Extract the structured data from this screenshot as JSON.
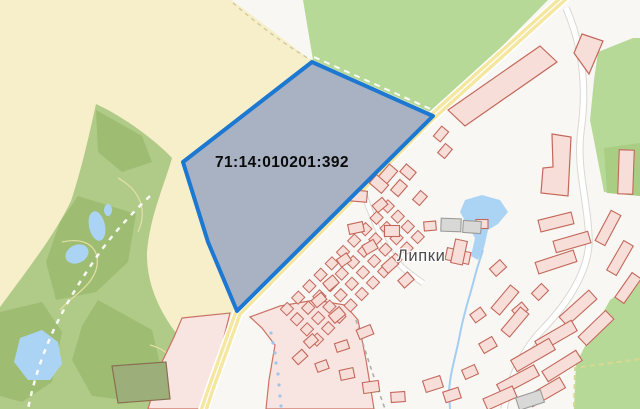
{
  "map": {
    "width": 640,
    "height": 409,
    "parcel": {
      "label": "71:14:010201:392",
      "points": "312,62 433,116 237,311 208,242 183,162",
      "fill": "#a9b2c3",
      "stroke": "#1d78d1",
      "stroke_width": 4
    },
    "village_label": {
      "text": "Липки",
      "color": "#424242"
    },
    "palette": {
      "background": "#f8f7f3",
      "field_yellow": "#f6efc9",
      "meadow_green": "#b7d998",
      "forest_olive": "#b0ca88",
      "forest_dark": "#9ebc72",
      "water": "#abd4f4",
      "road_yellow": "#f6e7a0",
      "road_casing": "#ffffff",
      "building_fill": "#f8ded8",
      "building_stroke": "#c4675b",
      "building_gray": "#d8d8d6",
      "building_gray_stroke": "#9b9b99",
      "zone_pink": "#f8e5e2",
      "zone_stroke": "#cb7263",
      "parcel_fill": "#a9b2c3",
      "parcel_stroke": "#1d78d1"
    },
    "shapes": [
      {
        "name": "field-yellow",
        "tag": "polygon",
        "attrs": {
          "points": "0,0 232,0 313,60 435,114 237,311 203,409 0,409",
          "fill": "#f6efc9"
        }
      },
      {
        "name": "white-wedge",
        "tag": "polygon",
        "attrs": {
          "points": "232,0 304,0 312,61",
          "fill": "#f8f7f3"
        }
      },
      {
        "name": "meadow-green",
        "tag": "polygon",
        "attrs": {
          "points": "303,0 548,0 435,114 313,60",
          "fill": "#b7d998"
        }
      },
      {
        "name": "path-tan-dashed",
        "tag": "path",
        "attrs": {
          "d": "M 233,3 C 255,22 282,43 311,60",
          "fill": "none",
          "stroke": "#d5caa0",
          "stroke-width": 1.5,
          "stroke-dasharray": "4 4"
        }
      },
      {
        "name": "forest-olive",
        "tag": "path",
        "attrs": {
          "d": "M 96,104 C 126,118 156,141 172,158 C 164,186 150,216 147,252 C 146,286 162,316 180,338 L 172,372 L 166,409 L 0,409 L 0,307 C 28,269 56,233 71,201 C 81,171 89,136 96,104 Z",
          "fill": "#b0ca88"
        }
      },
      {
        "name": "forest-dark-patch",
        "tag": "polygon",
        "attrs": {
          "points": "78,196 136,214 128,262 96,292 56,300 46,262 60,222",
          "fill": "#9ebc72"
        }
      },
      {
        "name": "forest-dark-patch",
        "tag": "polygon",
        "attrs": {
          "points": "98,300 152,330 162,372 142,402 92,396 72,360 82,326",
          "fill": "#9ebc72"
        }
      },
      {
        "name": "forest-dark-patch",
        "tag": "polygon",
        "attrs": {
          "points": "96,110 142,136 152,162 122,172 98,152",
          "fill": "#9ebc72"
        }
      },
      {
        "name": "forest-dark-patch",
        "tag": "polygon",
        "attrs": {
          "points": "0,312 42,302 62,332 52,382 22,402 0,396",
          "fill": "#9ebc72"
        }
      },
      {
        "name": "contour-line",
        "tag": "path",
        "attrs": {
          "d": "M 62,242 C 88,236 102,250 96,270 C 90,288 72,296 60,310",
          "fill": "none",
          "stroke": "#e0dfa2",
          "stroke-width": 1.3
        }
      },
      {
        "name": "contour-line",
        "tag": "path",
        "attrs": {
          "d": "M 118,178 C 140,190 148,210 138,232",
          "fill": "none",
          "stroke": "#e0dfa2",
          "stroke-width": 1.3
        }
      },
      {
        "name": "contour-line",
        "tag": "path",
        "attrs": {
          "d": "M 150,345 C 170,350 180,365 172,382",
          "fill": "none",
          "stroke": "#e0dfa2",
          "stroke-width": 1.3
        }
      },
      {
        "name": "green-top-right",
        "tag": "polygon",
        "attrs": {
          "points": "598,52 633,38 640,38 640,196 604,192 590,120 594,80",
          "fill": "#b7d998"
        }
      },
      {
        "name": "green-top-right-dark",
        "tag": "polygon",
        "attrs": {
          "points": "604,148 640,143 640,196 607,193",
          "fill": "#a8cd83"
        }
      },
      {
        "name": "green-bottom-right",
        "tag": "polygon",
        "attrs": {
          "points": "640,278 610,300 590,336 576,364 574,409 640,409",
          "fill": "#b7d998"
        }
      },
      {
        "name": "green-boundary-dashed",
        "tag": "path",
        "attrs": {
          "d": "M 574,407 L 575,368 L 640,359",
          "fill": "none",
          "stroke": "#d8d98f",
          "stroke-width": 2,
          "stroke-dasharray": "5 4"
        }
      },
      {
        "name": "pink-strip-left",
        "tag": "polygon",
        "attrs": {
          "points": "182,318 230,313 206,409 148,409 162,362 174,337",
          "fill": "#f8e5e2",
          "stroke": "#cb7263",
          "stroke-width": 1.2
        }
      },
      {
        "name": "farm-compound",
        "tag": "polygon",
        "attrs": {
          "points": "112,366 166,362 170,399 118,403",
          "fill": "#9cae7a",
          "stroke": "#897050",
          "stroke-width": 1.2
        }
      },
      {
        "name": "pink-zone-center",
        "tag": "polygon",
        "attrs": {
          "points": "250,317 280,306 315,300 345,305 358,320 366,360 374,409 266,409 269,380 275,345 262,328",
          "fill": "#f8e5e2",
          "stroke": "#cb7263",
          "stroke-width": 1.2
        }
      },
      {
        "name": "pond",
        "tag": "ellipse",
        "attrs": {
          "cx": 97,
          "cy": 226,
          "rx": 8,
          "ry": 15,
          "transform": "rotate(-12 97 226)",
          "fill": "#abd4f4"
        }
      },
      {
        "name": "pond",
        "tag": "ellipse",
        "attrs": {
          "cx": 77,
          "cy": 254,
          "rx": 12,
          "ry": 9,
          "transform": "rotate(-25 77 254)",
          "fill": "#abd4f4"
        }
      },
      {
        "name": "pond",
        "tag": "ellipse",
        "attrs": {
          "cx": 108,
          "cy": 210,
          "rx": 4,
          "ry": 6,
          "fill": "#abd4f4"
        }
      },
      {
        "name": "pond-large",
        "tag": "polygon",
        "attrs": {
          "points": "20,338 42,330 58,342 62,364 50,380 28,380 14,362",
          "fill": "#abd4f4"
        }
      },
      {
        "name": "village-pond",
        "tag": "polygon",
        "attrs": {
          "points": "465,200 482,195 500,200 508,212 498,224 488,230 484,248 478,260 471,256 475,238 468,226 460,212",
          "fill": "#abd4f4"
        }
      },
      {
        "name": "forest-path-dashed",
        "tag": "path",
        "attrs": {
          "d": "M 150,196 C 130,215 112,235 98,255 C 84,275 68,300 56,325 C 44,350 34,378 28,409",
          "fill": "none",
          "stroke": "#ffffff",
          "stroke-width": 2.5,
          "stroke-dasharray": "5 6",
          "opacity": 0.9
        }
      },
      {
        "name": "street-casing",
        "tag": "path",
        "attrs": {
          "d": "M 566,8 C 580,40 588,80 581,130 C 576,170 588,200 589,240 C 589,272 566,305 544,328 C 522,350 510,378 504,409",
          "fill": "none",
          "stroke": "#dad8d0",
          "stroke-width": 7.5
        }
      },
      {
        "name": "street-fill",
        "tag": "path",
        "attrs": {
          "d": "M 566,8 C 580,40 588,80 581,130 C 576,170 588,200 589,240 C 589,272 566,305 544,328 C 522,350 510,378 504,409",
          "fill": "none",
          "stroke": "#ffffff",
          "stroke-width": 5.5
        }
      },
      {
        "name": "street-casing",
        "tag": "path",
        "attrs": {
          "d": "M 357,172 C 366,202 377,230 388,250 C 397,265 410,274 423,283",
          "fill": "none",
          "stroke": "#dad8d0",
          "stroke-width": 6.5
        }
      },
      {
        "name": "street-fill",
        "tag": "path",
        "attrs": {
          "d": "M 357,172 C 366,202 377,230 388,250 C 397,265 410,274 423,283",
          "fill": "none",
          "stroke": "#ffffff",
          "stroke-width": 4.5
        }
      },
      {
        "name": "main-road-casing",
        "tag": "path",
        "attrs": {
          "d": "M 566,-4 L 433,116 L 238,313 L 210,391 L 203,412",
          "fill": "none",
          "stroke": "#ffffff",
          "stroke-width": 11,
          "stroke-linejoin": "round"
        }
      },
      {
        "name": "main-road-fill",
        "tag": "path",
        "attrs": {
          "d": "M 566,-4 L 433,116 L 238,313 L 210,391 L 203,412",
          "fill": "none",
          "stroke": "#f6e7a0",
          "stroke-width": 8,
          "stroke-linejoin": "round"
        }
      },
      {
        "name": "main-road-centerline",
        "tag": "path",
        "attrs": {
          "d": "M 566,-4 L 433,116 L 238,313 L 210,391 L 203,412",
          "fill": "none",
          "stroke": "#ffffff",
          "stroke-width": 1.2,
          "stroke-linejoin": "round"
        }
      },
      {
        "name": "trail-gray-dashed",
        "tag": "path",
        "attrs": {
          "d": "M 356,320 C 364,348 374,378 385,409",
          "fill": "none",
          "stroke": "#b0aea6",
          "stroke-width": 1.6,
          "stroke-dasharray": "4 4"
        }
      },
      {
        "name": "stream-dotted",
        "tag": "dots",
        "r": 1.6,
        "fill": "#9cc6ec",
        "points": [
          [
            271,
            333
          ],
          [
            273,
            343
          ],
          [
            275,
            353
          ],
          [
            276,
            363
          ],
          [
            278,
            374
          ],
          [
            279,
            385
          ],
          [
            280,
            396
          ],
          [
            281,
            406
          ]
        ]
      },
      {
        "name": "stream",
        "tag": "path",
        "attrs": {
          "d": "M 483,250 C 479,262 477,268 475,276 C 470,296 464,312 460,334 C 456,356 450,372 449,392 L 450,409",
          "fill": "none",
          "stroke": "#a3cdf2",
          "stroke-width": 2
        }
      },
      {
        "name": "parcel-grid",
        "tag": "grid",
        "spec": {
          "origin": [
            287,
            309
          ],
          "u": [
            11.2,
            -11.4
          ],
          "v": [
            10.0,
            10.2
          ],
          "cols": 10,
          "rows": 4,
          "cell": [
            9.6,
            9.0
          ],
          "rot": -45.5,
          "fill": "#f8ded8",
          "stroke": "#c4675b"
        }
      },
      {
        "name": "building-parallelogram",
        "tag": "polygon",
        "attrs": {
          "points": "448,110 540,46 557,62 465,126",
          "fill": "#f8ded8",
          "stroke": "#c4675b",
          "stroke-width": 1.2
        }
      },
      {
        "name": "building-flag",
        "tag": "polygon",
        "attrs": {
          "points": "582,34 603,41 589,74 574,53",
          "fill": "#f8ded8",
          "stroke": "#c4675b",
          "stroke-width": 1.2
        }
      },
      {
        "name": "building-L",
        "tag": "polygon",
        "attrs": {
          "points": "552,134 571,137 568,196 541,193 543,168 553,167",
          "fill": "#f8ded8",
          "stroke": "#c4675b",
          "stroke-width": 1.2
        }
      },
      {
        "tag": "b",
        "r": [
          374,
          163,
          15,
          11,
          -49
        ]
      },
      {
        "tag": "b",
        "r": [
          388,
          174,
          17,
          11,
          -49
        ]
      },
      {
        "tag": "b",
        "r": [
          379,
          184,
          11,
          16,
          -49
        ]
      },
      {
        "tag": "b",
        "r": [
          399,
          188,
          14,
          10,
          -49
        ]
      },
      {
        "tag": "b",
        "r": [
          408,
          172,
          10,
          13,
          -49
        ]
      },
      {
        "tag": "b",
        "r": [
          420,
          198,
          12,
          9,
          -49
        ]
      },
      {
        "tag": "b",
        "r": [
          441,
          134,
          13,
          9,
          -50
        ]
      },
      {
        "tag": "b",
        "r": [
          445,
          151,
          12,
          9,
          -50
        ]
      },
      {
        "tag": "b",
        "r": [
          358,
          196,
          18,
          11,
          5
        ]
      },
      {
        "tag": "b",
        "r": [
          380,
          205,
          13,
          9,
          -40
        ]
      },
      {
        "tag": "b",
        "r": [
          356,
          228,
          15,
          10,
          -12
        ]
      },
      {
        "tag": "b",
        "r": [
          370,
          247,
          13,
          10,
          -30
        ]
      },
      {
        "tag": "b",
        "r": [
          390,
          265,
          14,
          10,
          -42
        ]
      },
      {
        "tag": "b",
        "r": [
          406,
          280,
          13,
          10,
          -42
        ]
      },
      {
        "tag": "b",
        "r": [
          344,
          260,
          12,
          9,
          -35
        ]
      },
      {
        "tag": "b",
        "r": [
          331,
          283,
          13,
          10,
          -40
        ]
      },
      {
        "tag": "b",
        "r": [
          319,
          300,
          13,
          9,
          -40
        ]
      },
      {
        "tag": "b",
        "r": [
          337,
          315,
          14,
          10,
          -40
        ]
      },
      {
        "tag": "b",
        "r": [
          365,
          332,
          15,
          10,
          -22
        ]
      },
      {
        "tag": "b",
        "r": [
          342,
          346,
          13,
          9,
          -18
        ]
      },
      {
        "tag": "b",
        "r": [
          311,
          341,
          12,
          9,
          -42
        ]
      },
      {
        "tag": "b",
        "r": [
          300,
          357,
          13,
          9,
          -42
        ]
      },
      {
        "tag": "b",
        "r": [
          322,
          366,
          12,
          9,
          -20
        ]
      },
      {
        "tag": "b",
        "r": [
          347,
          374,
          14,
          10,
          -12
        ]
      },
      {
        "tag": "b",
        "r": [
          371,
          387,
          16,
          11,
          -8
        ]
      },
      {
        "tag": "b",
        "r": [
          398,
          397,
          14,
          10,
          -4
        ]
      },
      {
        "tag": "b",
        "r": [
          392,
          231,
          15,
          11,
          0
        ]
      },
      {
        "tag": "b",
        "r": [
          458,
          256,
          24,
          12,
          12
        ]
      },
      {
        "tag": "b",
        "r": [
          459,
          252,
          12,
          24,
          12
        ]
      },
      {
        "tag": "b",
        "r": [
          482,
          224,
          12,
          9,
          0
        ]
      },
      {
        "tag": "b",
        "r": [
          430,
          226,
          12,
          9,
          -5
        ]
      },
      {
        "tag": "b",
        "r": [
          556,
          222,
          34,
          12,
          -14
        ]
      },
      {
        "tag": "b",
        "r": [
          572,
          242,
          36,
          12,
          -16
        ]
      },
      {
        "tag": "b",
        "r": [
          556,
          262,
          40,
          12,
          -18
        ]
      },
      {
        "tag": "b",
        "r": [
          608,
          228,
          34,
          11,
          -62
        ]
      },
      {
        "tag": "b",
        "r": [
          620,
          258,
          34,
          11,
          -60
        ]
      },
      {
        "tag": "b",
        "r": [
          628,
          288,
          30,
          11,
          -55
        ]
      },
      {
        "tag": "b",
        "r": [
          578,
          308,
          40,
          12,
          -42
        ]
      },
      {
        "tag": "b",
        "r": [
          596,
          328,
          38,
          12,
          -44
        ]
      },
      {
        "tag": "b",
        "r": [
          556,
          336,
          42,
          12,
          -30
        ]
      },
      {
        "tag": "b",
        "r": [
          533,
          355,
          44,
          13,
          -30
        ]
      },
      {
        "tag": "b",
        "r": [
          562,
          366,
          40,
          12,
          -32
        ]
      },
      {
        "tag": "b",
        "r": [
          518,
          380,
          42,
          12,
          -28
        ]
      },
      {
        "tag": "b",
        "r": [
          546,
          392,
          38,
          12,
          -30
        ]
      },
      {
        "tag": "b",
        "r": [
          500,
          398,
          32,
          12,
          -24
        ]
      },
      {
        "tag": "b",
        "r": [
          626,
          172,
          15,
          44,
          2
        ]
      },
      {
        "tag": "b",
        "r": [
          540,
          292,
          14,
          10,
          -45
        ]
      },
      {
        "tag": "b",
        "r": [
          520,
          310,
          13,
          10,
          -40
        ]
      },
      {
        "tag": "b",
        "r": [
          505,
          300,
          30,
          11,
          -50
        ]
      },
      {
        "tag": "b",
        "r": [
          515,
          322,
          30,
          11,
          -50
        ]
      },
      {
        "tag": "b",
        "r": [
          433,
          384,
          18,
          12,
          -18
        ]
      },
      {
        "tag": "b",
        "r": [
          452,
          395,
          16,
          11,
          -18
        ]
      },
      {
        "tag": "b",
        "r": [
          470,
          372,
          14,
          10,
          -24
        ]
      },
      {
        "tag": "b",
        "r": [
          488,
          345,
          15,
          11,
          -30
        ]
      },
      {
        "tag": "b",
        "r": [
          478,
          315,
          13,
          10,
          -36
        ]
      },
      {
        "tag": "b",
        "r": [
          498,
          268,
          14,
          10,
          -42
        ]
      },
      {
        "tag": "b",
        "r": [
          451,
          225,
          20,
          13,
          2
        ],
        "f": "gray"
      },
      {
        "tag": "b",
        "r": [
          472,
          227,
          18,
          12,
          4
        ],
        "f": "gray"
      },
      {
        "tag": "b",
        "r": [
          530,
          400,
          26,
          13,
          -18
        ],
        "f": "gray"
      },
      {
        "name": "parcel-edge-path-dashed",
        "tag": "line",
        "attrs": {
          "x1": 314,
          "y1": 57,
          "x2": 435,
          "y2": 111,
          "stroke": "#ffffff",
          "stroke-width": 2,
          "stroke-dasharray": "6 5",
          "opacity": 0.95
        }
      },
      {
        "tag": "parcel",
        "name": "cadastral-parcel-polygon"
      }
    ]
  }
}
